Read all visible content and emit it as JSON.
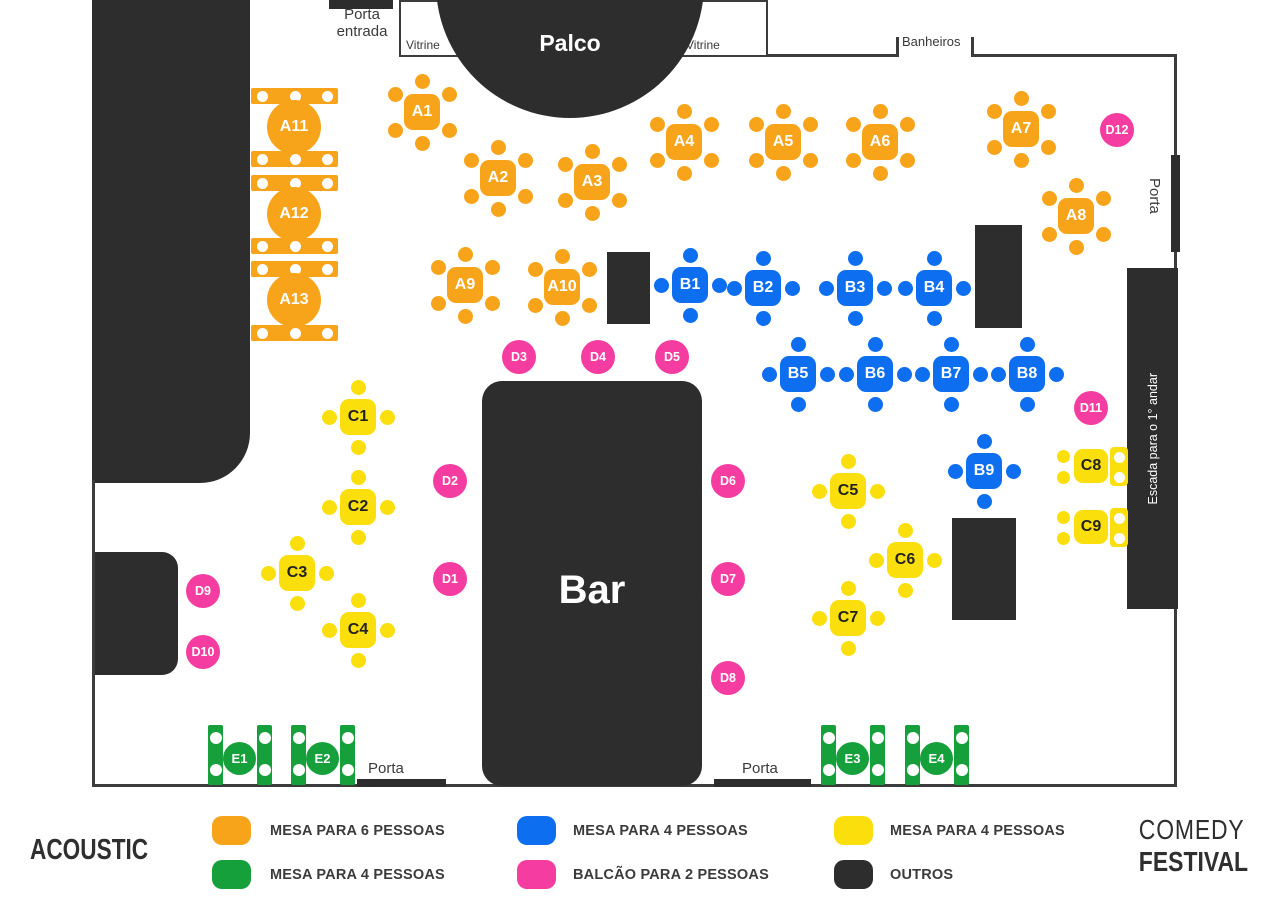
{
  "colors": {
    "orange": "#F7A41B",
    "blue": "#0D6EF0",
    "yellow": "#FBDF0C",
    "pink": "#F53DA1",
    "green": "#16A03C",
    "dark": "#2D2D2D",
    "wall": "#3C3C3C"
  },
  "map": {
    "labels": {
      "porta_entrada": "Porta entrada",
      "vitrine_left": "Vitrine",
      "vitrine_right": "Vitrine",
      "palco": "Palco",
      "banheiros": "Banheiros",
      "porta_right": "Porta",
      "porta_bottom_left": "Porta",
      "porta_bottom_right": "Porta",
      "escada": "Escada para o 1° andar",
      "bar": "Bar"
    },
    "tables": {
      "orange_six": [
        {
          "id": "A1",
          "x": 422,
          "y": 112
        },
        {
          "id": "A2",
          "x": 498,
          "y": 178
        },
        {
          "id": "A3",
          "x": 592,
          "y": 182
        },
        {
          "id": "A4",
          "x": 684,
          "y": 142
        },
        {
          "id": "A5",
          "x": 783,
          "y": 142
        },
        {
          "id": "A6",
          "x": 880,
          "y": 142
        },
        {
          "id": "A7",
          "x": 1021,
          "y": 129
        },
        {
          "id": "A8",
          "x": 1076,
          "y": 216
        },
        {
          "id": "A9",
          "x": 465,
          "y": 285
        },
        {
          "id": "A10",
          "x": 562,
          "y": 287
        }
      ],
      "orange_rows": {
        "bars_x": 251,
        "bars_w": 87,
        "bars_h": 16,
        "bars_y": [
          88,
          151,
          175,
          238,
          261,
          325
        ],
        "circles": [
          {
            "id": "A11",
            "x": 294,
            "y": 127
          },
          {
            "id": "A12",
            "x": 294,
            "y": 214
          },
          {
            "id": "A13",
            "x": 294,
            "y": 300
          }
        ]
      },
      "blue_four": [
        {
          "id": "B1",
          "x": 690,
          "y": 285
        },
        {
          "id": "B2",
          "x": 763,
          "y": 288
        },
        {
          "id": "B3",
          "x": 855,
          "y": 288
        },
        {
          "id": "B4",
          "x": 934,
          "y": 288
        },
        {
          "id": "B5",
          "x": 798,
          "y": 374
        },
        {
          "id": "B6",
          "x": 875,
          "y": 374
        },
        {
          "id": "B7",
          "x": 951,
          "y": 374
        },
        {
          "id": "B8",
          "x": 1027,
          "y": 374
        },
        {
          "id": "B9",
          "x": 984,
          "y": 471
        }
      ],
      "yellow_four": [
        {
          "id": "C1",
          "x": 358,
          "y": 417
        },
        {
          "id": "C2",
          "x": 358,
          "y": 507
        },
        {
          "id": "C3",
          "x": 297,
          "y": 573
        },
        {
          "id": "C4",
          "x": 358,
          "y": 630
        },
        {
          "id": "C5",
          "x": 848,
          "y": 491
        },
        {
          "id": "C6",
          "x": 905,
          "y": 560
        },
        {
          "id": "C7",
          "x": 848,
          "y": 618
        }
      ],
      "yellow_wall": [
        {
          "id": "C8",
          "x": 1091,
          "y": 466
        },
        {
          "id": "C9",
          "x": 1091,
          "y": 527
        }
      ],
      "pink_two": [
        {
          "id": "D1",
          "x": 450,
          "y": 579
        },
        {
          "id": "D2",
          "x": 450,
          "y": 481
        },
        {
          "id": "D3",
          "x": 519,
          "y": 357
        },
        {
          "id": "D4",
          "x": 598,
          "y": 357
        },
        {
          "id": "D5",
          "x": 672,
          "y": 357
        },
        {
          "id": "D6",
          "x": 728,
          "y": 481
        },
        {
          "id": "D7",
          "x": 728,
          "y": 579
        },
        {
          "id": "D8",
          "x": 728,
          "y": 678
        },
        {
          "id": "D9",
          "x": 203,
          "y": 591
        },
        {
          "id": "D10",
          "x": 203,
          "y": 652
        },
        {
          "id": "D11",
          "x": 1091,
          "y": 408
        },
        {
          "id": "D12",
          "x": 1117,
          "y": 130
        }
      ],
      "green_four": [
        {
          "id": "E1",
          "x": 240,
          "y": 759
        },
        {
          "id": "E2",
          "x": 323,
          "y": 759
        },
        {
          "id": "E3",
          "x": 853,
          "y": 759
        },
        {
          "id": "E4",
          "x": 937,
          "y": 759
        }
      ]
    }
  },
  "legend": {
    "items": [
      {
        "color": "#F7A41B",
        "label": "MESA PARA 6 PESSOAS"
      },
      {
        "color": "#16A03C",
        "label": "MESA PARA 4 PESSOAS"
      },
      {
        "color": "#0D6EF0",
        "label": "MESA PARA 4 PESSOAS"
      },
      {
        "color": "#F53DA1",
        "label": "BALCÃO PARA 2 PESSOAS"
      },
      {
        "color": "#FBDF0C",
        "label": "MESA PARA 4 PESSOAS"
      },
      {
        "color": "#2D2D2D",
        "label": "OUTROS"
      }
    ]
  },
  "footer": {
    "brand_left": "ACOUSTIC",
    "brand_right_top": "COMEDY",
    "brand_right_bottom": "FESTIVAL"
  }
}
